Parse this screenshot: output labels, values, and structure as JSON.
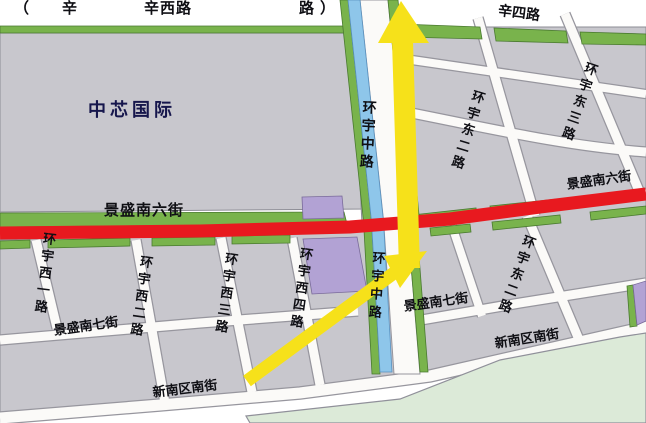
{
  "map": {
    "labels": {
      "top_paren_open": "（",
      "top_xin": "辛",
      "top_xinxilu": "辛西路",
      "top_lu": "路",
      "top_paren_close": "）",
      "xinsilu": "辛四路",
      "smic": "中芯国际",
      "jingsheng_s6_left": "景盛南六街",
      "jingsheng_s6_right": "景盛南六街",
      "huanyu_zhong_north": "环宇中路",
      "huanyu_zhong_south": "环宇中路",
      "huanyu_e2_north": "环宇东二路",
      "huanyu_e3": "环宇东三路",
      "huanyu_e2_south": "环宇东二路",
      "huanyu_w1": "环宇西一路",
      "huanyu_w2": "环宇西二路",
      "huanyu_w3": "环宇西三路",
      "huanyu_w4": "环宇西四路",
      "jingsheng_s7_left": "景盛南七街",
      "jingsheng_s7_right": "景盛南七街",
      "xinnan_south_left": "新南区南街",
      "xinnan_south_right": "新南区南街"
    },
    "colors": {
      "highlight_road": "#e8191f",
      "route_arrow": "#f6e11a",
      "canal": "#8ec6ea",
      "greenbelt": "#79b34c",
      "block": "#c8c7cd",
      "purple_block": "#b2a2d4",
      "park": "#dcead8",
      "road": "#fbfaf8",
      "road_casing": "#97969e"
    },
    "route_arrows": [
      "arrow-up",
      "arrow-northeast"
    ]
  }
}
